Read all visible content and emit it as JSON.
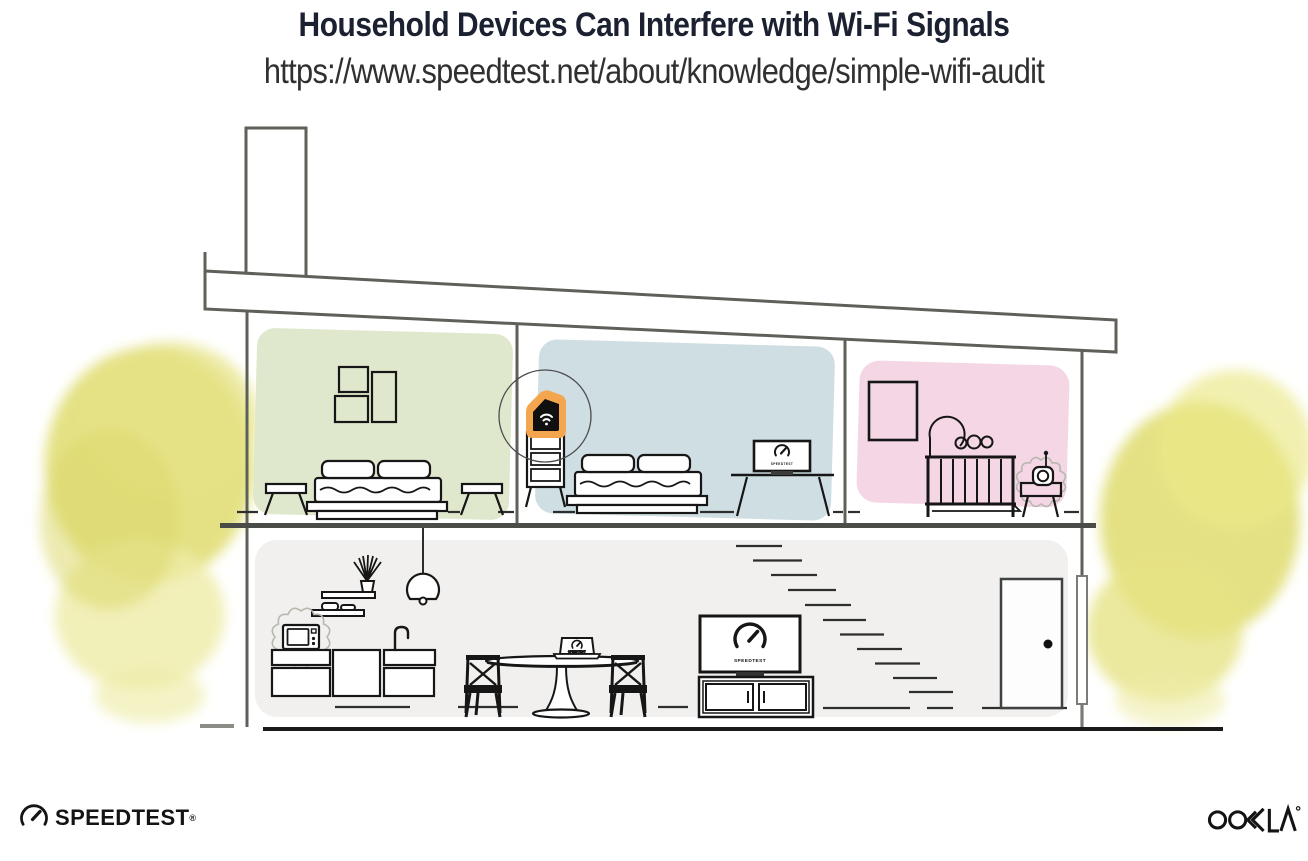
{
  "header": {
    "title": "Household Devices Can Interfere with Wi-Fi Signals",
    "url": "https://www.speedtest.net/about/knowledge/simple-wifi-audit"
  },
  "screens": {
    "tv_label": "SPEEDTEST",
    "desktop_label": "SPEEDTEST",
    "laptop_label": "SPEEDTEST"
  },
  "footer": {
    "speedtest_wordmark": "SPEEDTEST",
    "registered_mark": "®",
    "ookla_wordmark": "OOKLA"
  },
  "colors": {
    "title_navy": "#1b2130",
    "url_gray": "#303030",
    "line_gray": "#5d615a",
    "ink": "#161616",
    "room_green": "#dfe8cd",
    "room_blue": "#cfdee2",
    "room_pink": "#f5d6e5",
    "floor_gray": "#f1f0ee",
    "highlight_orange": "#f4a64e",
    "foliage_yellow": "#e1de77",
    "foliage_light": "#eeeca8"
  }
}
